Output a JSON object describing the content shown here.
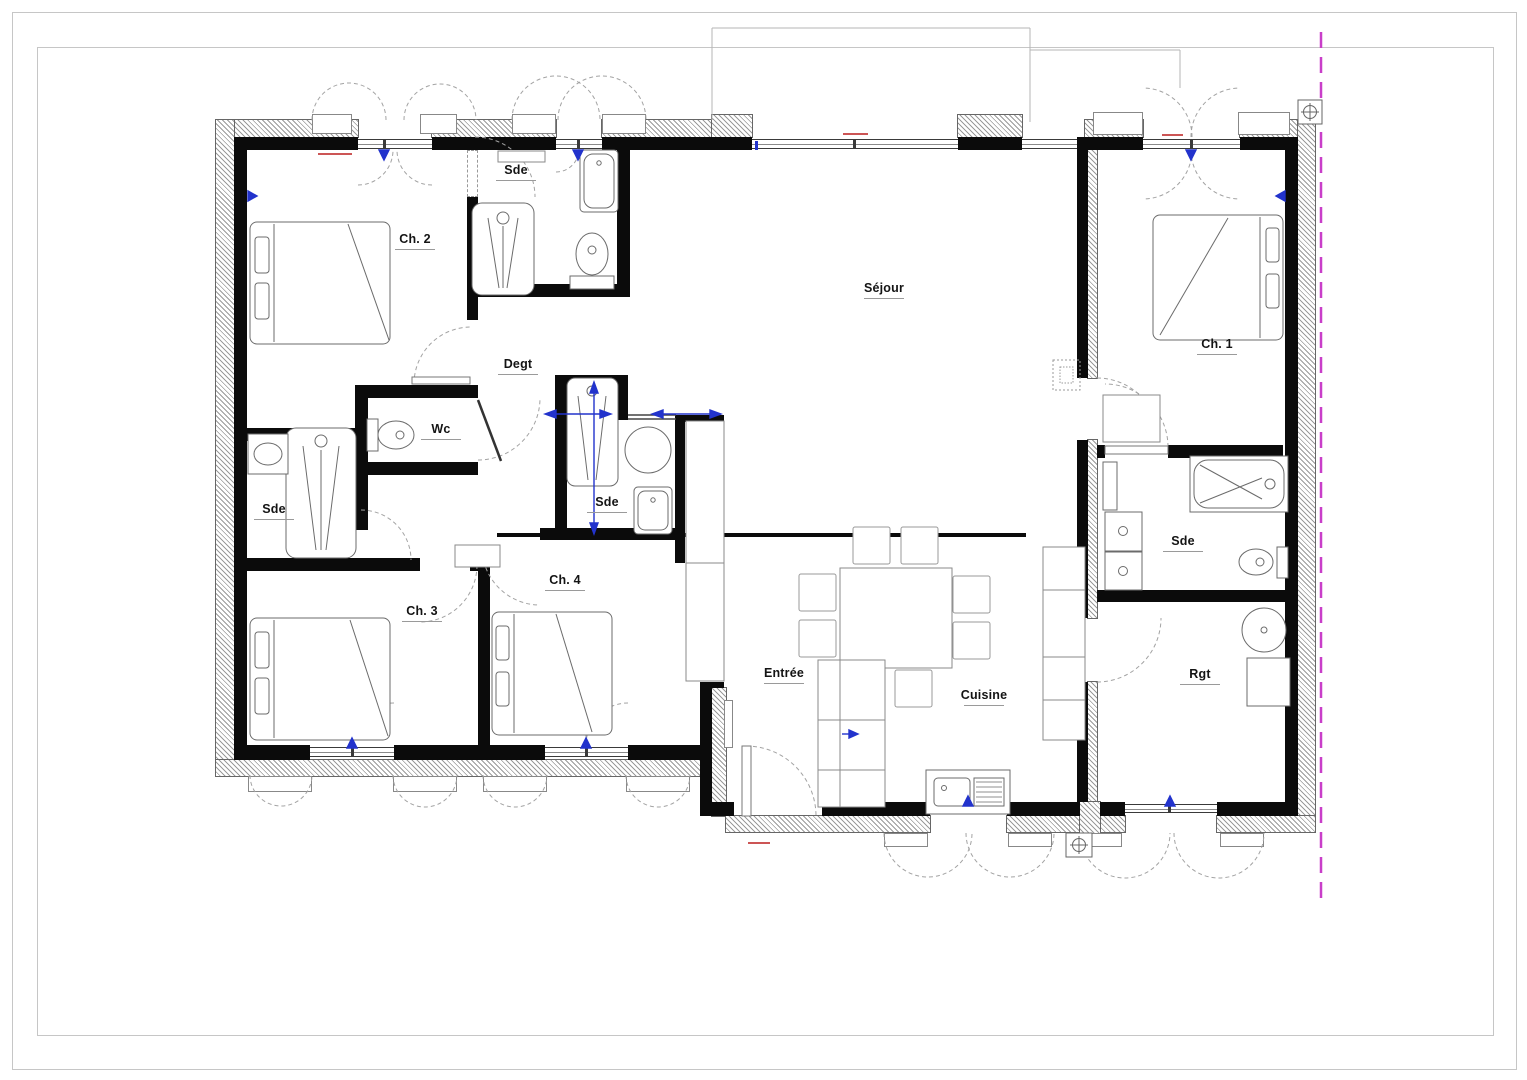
{
  "drawing": {
    "type": "architectural-floor-plan",
    "wall_color": "#0b0b0b",
    "property_line_color": "#c93ec9",
    "window_arrow_color": "#2233cc",
    "door_arc_color": "#a3a3a3"
  },
  "rooms": [
    {
      "id": "sde-top",
      "label": "Sde"
    },
    {
      "id": "ch2",
      "label": "Ch. 2"
    },
    {
      "id": "sejour",
      "label": "Séjour"
    },
    {
      "id": "ch1",
      "label": "Ch. 1"
    },
    {
      "id": "degt",
      "label": "Degt"
    },
    {
      "id": "wc",
      "label": "Wc"
    },
    {
      "id": "sde-left",
      "label": "Sde"
    },
    {
      "id": "sde-middle",
      "label": "Sde"
    },
    {
      "id": "sde-right",
      "label": "Sde"
    },
    {
      "id": "ch4",
      "label": "Ch. 4"
    },
    {
      "id": "ch3",
      "label": "Ch. 3"
    },
    {
      "id": "entree",
      "label": "Entrée"
    },
    {
      "id": "cuisine",
      "label": "Cuisine"
    },
    {
      "id": "rgt",
      "label": "Rgt"
    }
  ],
  "symbols": {
    "survey_marker_icon": "crosshair-in-box",
    "survey_marker_count": 2
  }
}
